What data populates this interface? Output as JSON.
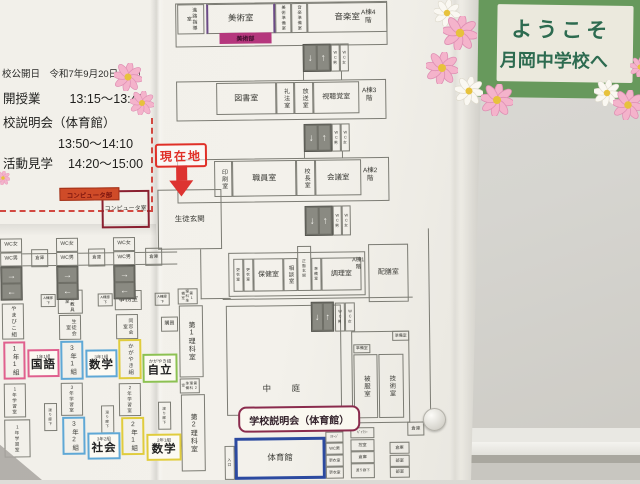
{
  "welcome_sign": {
    "line1": "ようこそ",
    "line2": "月岡中学校へ"
  },
  "schedule": {
    "date_line": "校公開日　令和7年9月20日（土）",
    "row1_label": "開授業",
    "row1_time": "13:15～13:40",
    "row2_label": "校説明会（体育館）",
    "row2_time": "13:50～14:10",
    "row3_label": "活動見学",
    "row3_time": "14:20～15:00"
  },
  "markers": {
    "current_location": "現在地",
    "computer_club_tag": "コンピュータ部",
    "art_club_tag": "美術部",
    "session_banner": "学校説明会（体育館）"
  },
  "class_tags": [
    {
      "id": "t1",
      "small": "1年1組",
      "big": "国語",
      "color": "#e0608e"
    },
    {
      "id": "t2",
      "small": "3年1組",
      "big": "数学",
      "color": "#5fa8d6"
    },
    {
      "id": "t3",
      "small": "かがやき組",
      "big": "自立",
      "color": "#8cc152"
    },
    {
      "id": "t4",
      "small": "3年2組",
      "big": "社会",
      "color": "#5fa8d6"
    },
    {
      "id": "t5",
      "small": "2年1組",
      "big": "数学",
      "color": "#e0cc3d"
    }
  ],
  "map": {
    "floor_labels": [
      "A棟4階",
      "A棟3階",
      "A棟2階",
      "A棟1階"
    ],
    "rooms": [
      {
        "id": "shinro",
        "label": "進路指導室"
      },
      {
        "id": "bijutsu",
        "label": "美術室"
      },
      {
        "id": "bijyun",
        "label": "美術準備室"
      },
      {
        "id": "onjyun",
        "label": "音楽準備室"
      },
      {
        "id": "ongaku",
        "label": "音楽室"
      },
      {
        "id": "f4",
        "label": "A棟4階"
      },
      {
        "id": "awc4m",
        "label": "WC男"
      },
      {
        "id": "awc4f",
        "label": "WC女"
      },
      {
        "id": "tosho",
        "label": "図書室"
      },
      {
        "id": "reihou",
        "label": "礼法室"
      },
      {
        "id": "housou",
        "label": "放送室"
      },
      {
        "id": "shichokaku",
        "label": "視聴覚室"
      },
      {
        "id": "f3",
        "label": "A棟3階"
      },
      {
        "id": "awc3m",
        "label": "WC男"
      },
      {
        "id": "awc3f",
        "label": "WC女"
      },
      {
        "id": "insatsu",
        "label": "印刷室"
      },
      {
        "id": "shokuin",
        "label": "職員室"
      },
      {
        "id": "kouchou",
        "label": "校長室"
      },
      {
        "id": "kaigi",
        "label": "会議室"
      },
      {
        "id": "f2",
        "label": "A棟2階"
      },
      {
        "id": "awc2m",
        "label": "WC男"
      },
      {
        "id": "awc2f",
        "label": "WC女"
      },
      {
        "id": "genkan",
        "label": "生徒玄関"
      },
      {
        "id": "pcroom",
        "label": "コンピュータ室"
      },
      {
        "id": "wcf1",
        "label": "WC女"
      },
      {
        "id": "wcm1",
        "label": "WC男"
      },
      {
        "id": "wcf2",
        "label": "WC女"
      },
      {
        "id": "wcm2",
        "label": "WC男"
      },
      {
        "id": "wcf3",
        "label": "WC女"
      },
      {
        "id": "wcm3",
        "label": "WC男"
      },
      {
        "id": "souko1",
        "label": "倉庫"
      },
      {
        "id": "souko2",
        "label": "倉庫"
      },
      {
        "id": "souko3",
        "label": "倉庫"
      },
      {
        "id": "rouka1",
        "label": "A棟廊下"
      },
      {
        "id": "rouka2",
        "label": "A棟廊下"
      },
      {
        "id": "rouka3",
        "label": "A棟廊下"
      },
      {
        "id": "yamabiko",
        "label": "やまびこ組"
      },
      {
        "id": "c11",
        "label": "1年1組"
      },
      {
        "id": "g1a",
        "label": "1年学習室"
      },
      {
        "id": "g1b",
        "label": "1年学習室"
      },
      {
        "id": "kyouzai",
        "label": "教材教具室"
      },
      {
        "id": "seitokai",
        "label": "生徒会室"
      },
      {
        "id": "c31",
        "label": "3年1組"
      },
      {
        "id": "g3a",
        "label": "3年学習室"
      },
      {
        "id": "c32",
        "label": "3年2組"
      },
      {
        "id": "jimu",
        "label": "事務室"
      },
      {
        "id": "dousou",
        "label": "同窓会室"
      },
      {
        "id": "kagayaki",
        "label": "かがやき組"
      },
      {
        "id": "g2a",
        "label": "2年学習室"
      },
      {
        "id": "c21",
        "label": "2年1組"
      },
      {
        "id": "watari1",
        "label": "渡り廊下"
      },
      {
        "id": "watari2",
        "label": "渡り廊下"
      },
      {
        "id": "watari3",
        "label": "渡り廊下"
      },
      {
        "id": "rika1jun",
        "label": "第1理科準備室"
      },
      {
        "id": "rika1",
        "label": "第1理科室"
      },
      {
        "id": "rika2jun",
        "label": "第2理科準備室"
      },
      {
        "id": "rika2",
        "label": "第2理科室"
      },
      {
        "id": "koubai",
        "label": "購買"
      },
      {
        "id": "koui1",
        "label": "更衣室"
      },
      {
        "id": "koui2",
        "label": "更衣室"
      },
      {
        "id": "hoken",
        "label": "保健室"
      },
      {
        "id": "soudan",
        "label": "相談室"
      },
      {
        "id": "seimen",
        "label": "正面玄関"
      },
      {
        "id": "chourijun",
        "label": "準備室"
      },
      {
        "id": "chouri",
        "label": "調理室"
      },
      {
        "id": "f1",
        "label": "A棟1階"
      },
      {
        "id": "haizen",
        "label": "配膳室"
      },
      {
        "id": "nakaniwa",
        "label": "中　庭"
      },
      {
        "id": "cwcm",
        "label": "WC男"
      },
      {
        "id": "cwcf",
        "label": "WC女"
      },
      {
        "id": "junbi1",
        "label": "準備室"
      },
      {
        "id": "junbi2",
        "label": "準備室"
      },
      {
        "id": "hifuku",
        "label": "被服室"
      },
      {
        "id": "gijutsu",
        "label": "技術室"
      },
      {
        "id": "taiiku",
        "label": "体育館"
      },
      {
        "id": "iriguchi",
        "label": "入口"
      },
      {
        "id": "stage",
        "label": "ｽﾃｰｼﾞ"
      },
      {
        "id": "gwcm",
        "label": "WC男"
      },
      {
        "id": "gkoui1",
        "label": "更衣室"
      },
      {
        "id": "gkoui2",
        "label": "更衣室"
      },
      {
        "id": "gyarari",
        "label": "ｷﾞｬﾗﾘｰ"
      },
      {
        "id": "hikae",
        "label": "控室"
      },
      {
        "id": "gsouko",
        "label": "倉庫"
      },
      {
        "id": "gwatari",
        "label": "渡り廊下"
      },
      {
        "id": "souko4",
        "label": "倉庫"
      },
      {
        "id": "souko5",
        "label": "倉庫"
      },
      {
        "id": "bushitsu1",
        "label": "部室"
      },
      {
        "id": "bushitsu2",
        "label": "部室"
      }
    ]
  },
  "colors": {
    "sign_green": "#67995c",
    "sign_text": "#2d6b50",
    "highlight_pink": "#e0608e",
    "highlight_blue": "#5fa8d6",
    "highlight_yellow": "#e0cc3d",
    "highlight_green": "#8cc152",
    "current_location_red": "#e03028",
    "gym_blue": "#2c4aa0",
    "banner_maroon": "#8a2b4d",
    "computer_tag": "#cf4b28",
    "art_tag": "#b5377d"
  }
}
